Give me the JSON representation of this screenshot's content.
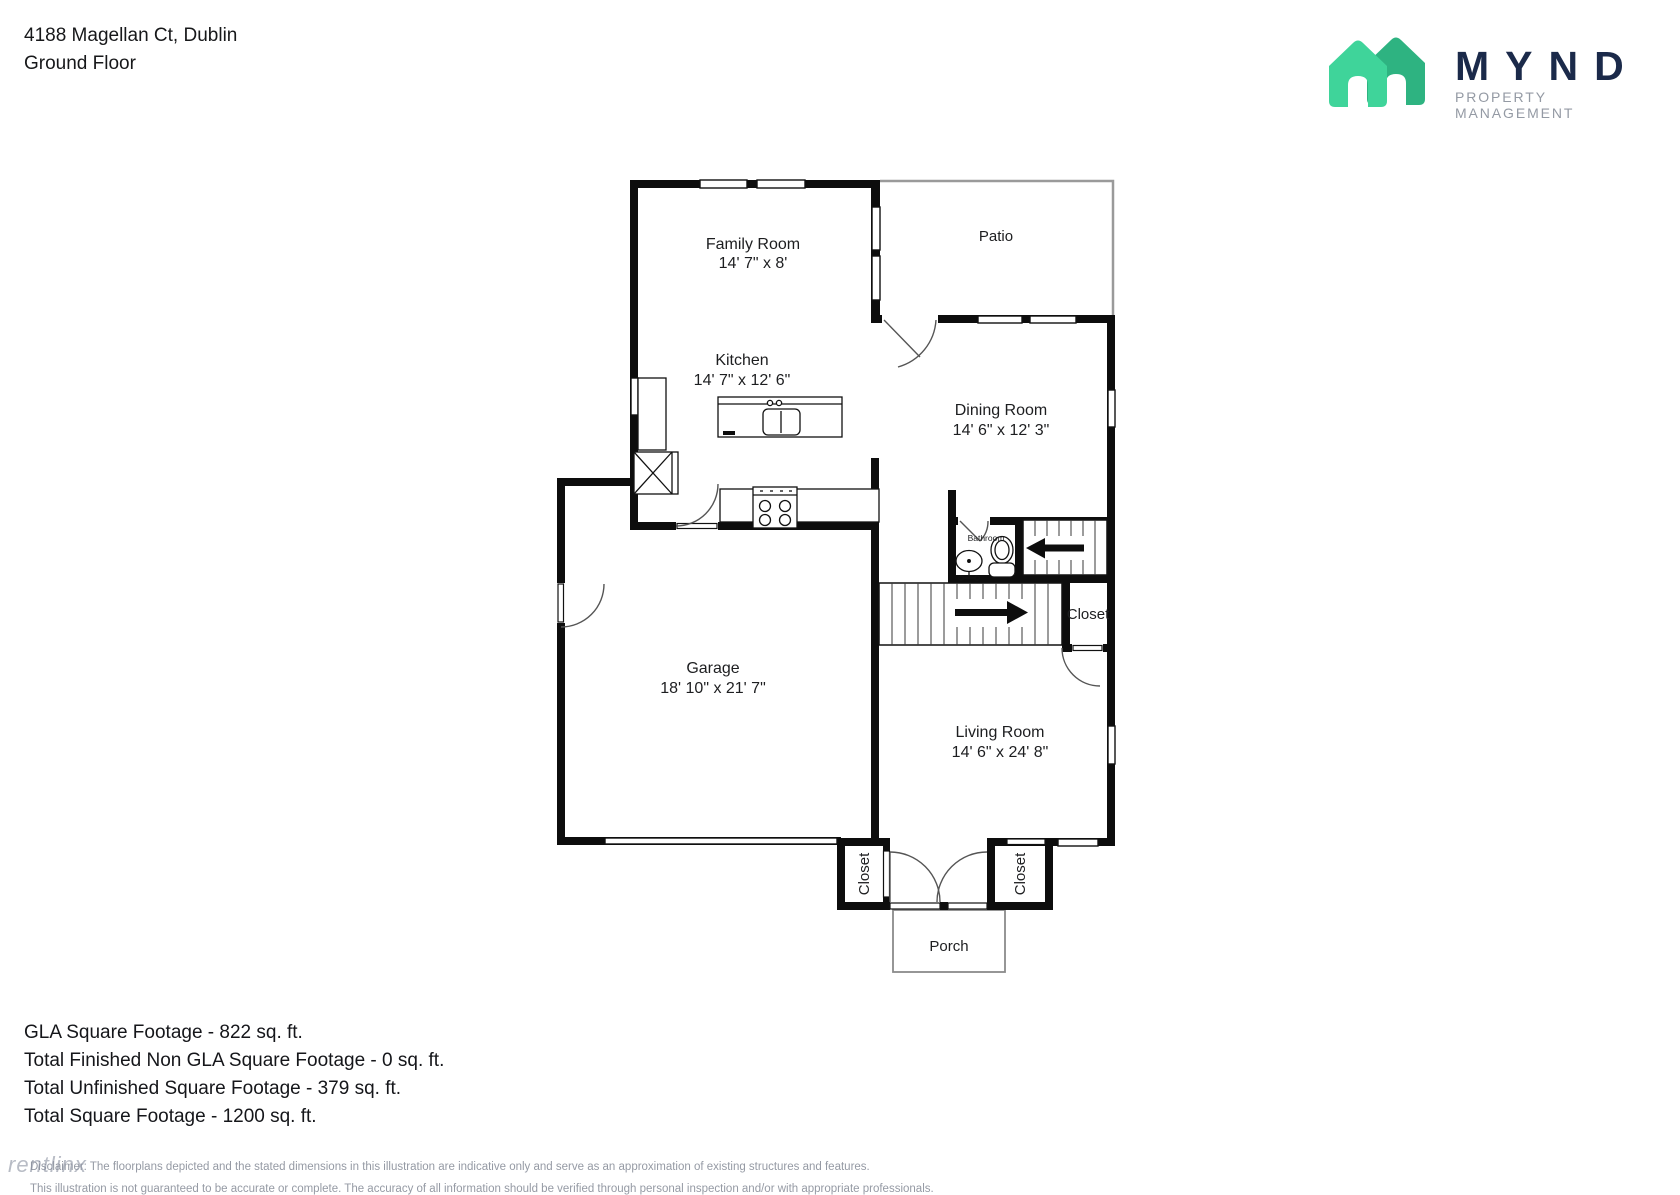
{
  "header": {
    "address": "4188 Magellan Ct, Dublin",
    "floor": "Ground Floor"
  },
  "logo": {
    "brand": "MYND",
    "tagline": "PROPERTY MANAGEMENT",
    "house_light": "#3fd49a",
    "house_dark": "#2eb381",
    "navy": "#1b2a4a"
  },
  "plan": {
    "rooms": [
      {
        "name": "Family Room",
        "dims": "14' 7\" x 8'"
      },
      {
        "name": "Patio"
      },
      {
        "name": "Kitchen",
        "dims": "14' 7\" x 12' 6\""
      },
      {
        "name": "Dining Room",
        "dims": "14' 6\" x 12' 3\""
      },
      {
        "name": "Garage",
        "dims": "18' 10\" x 21' 7\""
      },
      {
        "name": "Bathroom"
      },
      {
        "name": "Living Room",
        "dims": "14' 6\" x 24' 8\""
      }
    ],
    "closet_labels": [
      "Closet",
      "Closet",
      "Closet"
    ],
    "porch_label": "Porch"
  },
  "summary": {
    "lines": [
      "GLA Square Footage - 822 sq. ft.",
      "Total Finished Non GLA Square Footage - 0 sq. ft.",
      "Total Unfinished Square Footage - 379 sq. ft.",
      "Total Square Footage - 1200 sq. ft."
    ]
  },
  "disclaimer": {
    "line1": "Disclaimer: The floorplans depicted and the stated dimensions in this illustration are indicative only and serve as an approximation of existing structures and features.",
    "line2": "This illustration is not guaranteed to be accurate or complete. The accuracy of all information should be verified through personal inspection and/or with appropriate professionals."
  },
  "watermark": "rentlinx"
}
